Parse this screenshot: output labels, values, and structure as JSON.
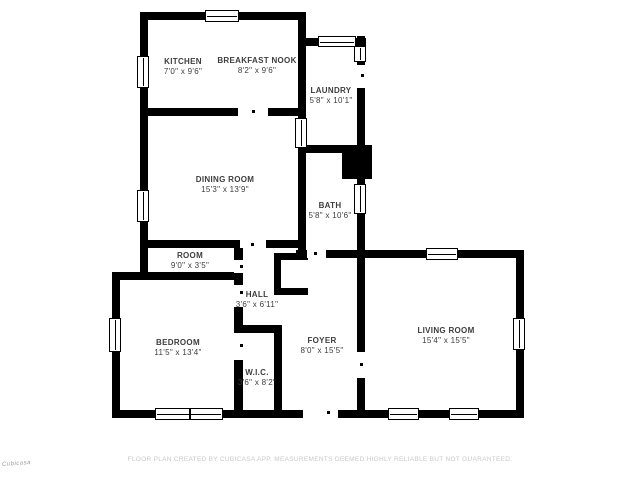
{
  "page": {
    "background": "#ffffff",
    "wall_color": "#000000",
    "label_color": "#3d3d3d",
    "disclaimer_color": "#c9c9c9"
  },
  "footer": {
    "disclaimer": "FLOOR PLAN CREATED BY CUBICASA APP. MEASUREMENTS DEEMED HIGHLY RELIABLE BUT NOT GUARANTEED."
  },
  "watermark": {
    "label": "Cubicasa"
  },
  "plan": {
    "rooms": [
      {
        "id": "kitchen",
        "name": "KITCHEN",
        "dims": "7'0\" x 9'6\"",
        "cx": 183,
        "cy": 67
      },
      {
        "id": "breakfast-nook",
        "name": "BREAKFAST NOOK",
        "dims": "8'2\" x 9'6\"",
        "cx": 257,
        "cy": 66
      },
      {
        "id": "laundry",
        "name": "LAUNDRY",
        "dims": "5'8\" x 10'1\"",
        "cx": 331,
        "cy": 96
      },
      {
        "id": "dining-room",
        "name": "DINING ROOM",
        "dims": "15'3\" x 13'9\"",
        "cx": 225,
        "cy": 185
      },
      {
        "id": "bath",
        "name": "BATH",
        "dims": "5'8\" x 10'6\"",
        "cx": 330,
        "cy": 211
      },
      {
        "id": "room",
        "name": "ROOM",
        "dims": "9'0\" x 3'5\"",
        "cx": 190,
        "cy": 261
      },
      {
        "id": "hall",
        "name": "HALL",
        "dims": "3'6\" x 6'11\"",
        "cx": 257,
        "cy": 300
      },
      {
        "id": "bedroom",
        "name": "BEDROOM",
        "dims": "11'5\" x 13'4\"",
        "cx": 178,
        "cy": 348
      },
      {
        "id": "wic",
        "name": "W.I.C.",
        "dims": "3'6\" x 8'2\"",
        "cx": 257,
        "cy": 378
      },
      {
        "id": "foyer",
        "name": "FOYER",
        "dims": "8'0\" x 15'5\"",
        "cx": 322,
        "cy": 346
      },
      {
        "id": "living-room",
        "name": "LIVING ROOM",
        "dims": "15'4\" x 15'5\"",
        "cx": 446,
        "cy": 336
      }
    ],
    "walls": [
      {
        "id": "top-wall",
        "x": 140,
        "y": 12,
        "w": 166,
        "h": 8
      },
      {
        "id": "left-wall",
        "x": 140,
        "y": 12,
        "w": 8,
        "h": 268
      },
      {
        "id": "kitchen-laundry-wall",
        "x": 298,
        "y": 12,
        "w": 8,
        "h": 246
      },
      {
        "id": "laundry-top-wall",
        "x": 306,
        "y": 38,
        "w": 60,
        "h": 8
      },
      {
        "id": "laundry-right-wall",
        "x": 357,
        "y": 36,
        "w": 8,
        "h": 117
      },
      {
        "id": "laundry-bath-divider",
        "x": 298,
        "y": 145,
        "w": 74,
        "h": 8
      },
      {
        "id": "chimney-block",
        "x": 342,
        "y": 153,
        "w": 30,
        "h": 26
      },
      {
        "id": "bath-right-wall",
        "x": 357,
        "y": 145,
        "w": 8,
        "h": 113
      },
      {
        "id": "bath-bottom-wall",
        "x": 296,
        "y": 250,
        "w": 69,
        "h": 8
      },
      {
        "id": "kitchen-bottom-wall",
        "x": 140,
        "y": 108,
        "w": 166,
        "h": 8
      },
      {
        "id": "dining-bottom-wall",
        "x": 140,
        "y": 240,
        "w": 158,
        "h": 8
      },
      {
        "id": "room-bottom-wall",
        "x": 112,
        "y": 272,
        "w": 131,
        "h": 8
      },
      {
        "id": "bedroom-left-wall",
        "x": 112,
        "y": 272,
        "w": 8,
        "h": 146
      },
      {
        "id": "bottom-wall",
        "x": 112,
        "y": 410,
        "w": 412,
        "h": 8
      },
      {
        "id": "hall-west-wall",
        "x": 234,
        "y": 240,
        "w": 9,
        "h": 178
      },
      {
        "id": "wic-top-wall",
        "x": 234,
        "y": 325,
        "w": 48,
        "h": 8
      },
      {
        "id": "wic-right-wall",
        "x": 274,
        "y": 325,
        "w": 8,
        "h": 93
      },
      {
        "id": "closet-top-wall",
        "x": 274,
        "y": 253,
        "w": 34,
        "h": 7
      },
      {
        "id": "closet-left-wall",
        "x": 274,
        "y": 253,
        "w": 7,
        "h": 42
      },
      {
        "id": "closet-bottom-wall",
        "x": 274,
        "y": 288,
        "w": 34,
        "h": 7
      },
      {
        "id": "foyer-living-divider",
        "x": 357,
        "y": 250,
        "w": 8,
        "h": 168
      },
      {
        "id": "living-top-wall",
        "x": 357,
        "y": 250,
        "w": 167,
        "h": 8
      },
      {
        "id": "living-right-wall",
        "x": 516,
        "y": 250,
        "w": 8,
        "h": 168
      }
    ],
    "door_gaps": [
      {
        "id": "kitchen-dining-door",
        "x": 238,
        "y": 108,
        "w": 30,
        "h": 8
      },
      {
        "id": "dining-hall-door",
        "x": 240,
        "y": 240,
        "w": 26,
        "h": 8
      },
      {
        "id": "bath-door",
        "x": 307,
        "y": 250,
        "w": 19,
        "h": 8
      },
      {
        "id": "laundry-exterior-door",
        "x": 357,
        "y": 65,
        "w": 8,
        "h": 23
      },
      {
        "id": "room-door",
        "x": 234,
        "y": 260,
        "w": 9,
        "h": 13
      },
      {
        "id": "bedroom-door",
        "x": 234,
        "y": 285,
        "w": 9,
        "h": 22
      },
      {
        "id": "wic-door",
        "x": 234,
        "y": 333,
        "w": 9,
        "h": 27
      },
      {
        "id": "front-entry-door",
        "x": 303,
        "y": 410,
        "w": 35,
        "h": 8
      },
      {
        "id": "foyer-living-opening",
        "x": 357,
        "y": 352,
        "w": 8,
        "h": 26
      }
    ],
    "windows": [
      {
        "id": "top-window",
        "x": 205,
        "y": 10,
        "w": 34,
        "h": 12,
        "orient": "h",
        "panes": 1
      },
      {
        "id": "kitchen-left-window",
        "x": 137,
        "y": 56,
        "w": 12,
        "h": 32,
        "orient": "v",
        "panes": 1
      },
      {
        "id": "laundry-top-window",
        "x": 318,
        "y": 36,
        "w": 38,
        "h": 11,
        "orient": "h",
        "panes": 1
      },
      {
        "id": "laundry-right-window",
        "x": 354,
        "y": 46,
        "w": 12,
        "h": 16,
        "orient": "v",
        "panes": 1
      },
      {
        "id": "dining-bath-window",
        "x": 295,
        "y": 118,
        "w": 12,
        "h": 30,
        "orient": "v",
        "panes": 1
      },
      {
        "id": "dining-left-window",
        "x": 137,
        "y": 190,
        "w": 12,
        "h": 32,
        "orient": "v",
        "panes": 1
      },
      {
        "id": "bath-right-window",
        "x": 354,
        "y": 184,
        "w": 12,
        "h": 30,
        "orient": "v",
        "panes": 1
      },
      {
        "id": "bedroom-left-window",
        "x": 109,
        "y": 318,
        "w": 12,
        "h": 34,
        "orient": "v",
        "panes": 1
      },
      {
        "id": "bedroom-bottom-window",
        "x": 155,
        "y": 408,
        "w": 68,
        "h": 12,
        "orient": "h",
        "panes": 2
      },
      {
        "id": "living-top-window",
        "x": 426,
        "y": 248,
        "w": 32,
        "h": 12,
        "orient": "h",
        "panes": 1
      },
      {
        "id": "living-right-window",
        "x": 513,
        "y": 318,
        "w": 12,
        "h": 32,
        "orient": "v",
        "panes": 1
      },
      {
        "id": "living-bottom-window-1",
        "x": 388,
        "y": 408,
        "w": 31,
        "h": 12,
        "orient": "h",
        "panes": 1
      },
      {
        "id": "living-bottom-window-2",
        "x": 449,
        "y": 408,
        "w": 30,
        "h": 12,
        "orient": "h",
        "panes": 1
      }
    ],
    "door_marks": [
      {
        "x": 252,
        "y": 110
      },
      {
        "x": 251,
        "y": 243
      },
      {
        "x": 314,
        "y": 252
      },
      {
        "x": 327,
        "y": 411
      },
      {
        "x": 360,
        "y": 363
      },
      {
        "x": 240,
        "y": 291
      },
      {
        "x": 240,
        "y": 265
      },
      {
        "x": 240,
        "y": 344
      },
      {
        "x": 361,
        "y": 74
      }
    ]
  }
}
